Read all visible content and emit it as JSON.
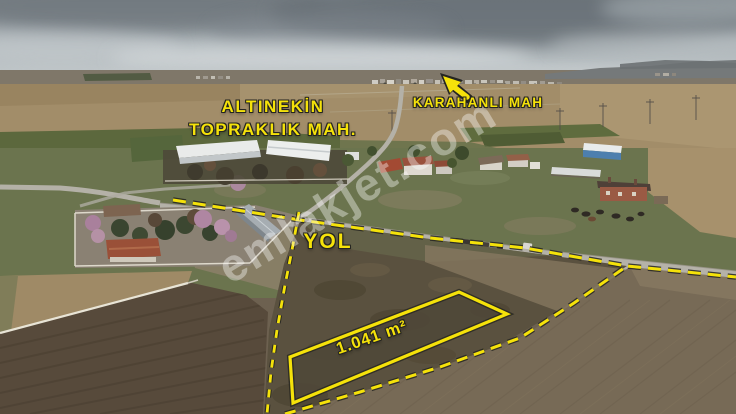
{
  "image": {
    "width": 736,
    "height": 414,
    "description": "Aerial drone photo of rural land for sale with annotation overlay"
  },
  "watermark": {
    "text": "emlakjet.com"
  },
  "labels": {
    "neighborhood_line1": "ALTINEKİN",
    "neighborhood_line2": "TOPRAKLIK MAH.",
    "village": "KARAHANLI MAH",
    "road": "YOL",
    "parcel_area": "1.041 m²"
  },
  "colors": {
    "annotation_yellow": "#f5e20a",
    "annotation_outline": "#252521",
    "watermark_white": "rgba(255,255,255,0.38)"
  }
}
